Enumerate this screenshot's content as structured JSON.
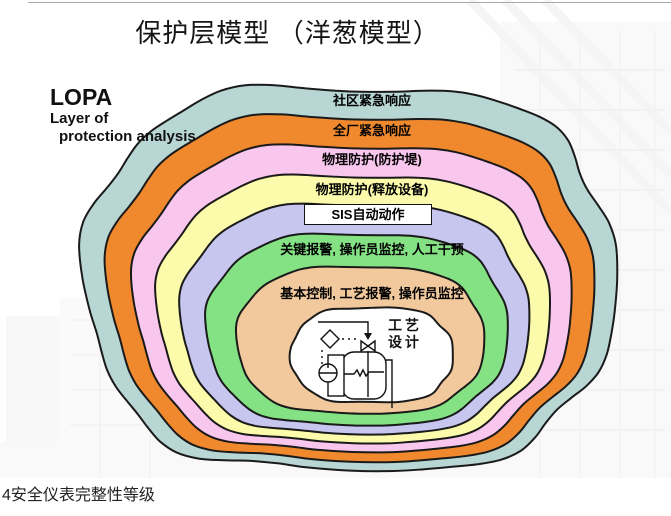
{
  "title": "保护层模型 （洋葱模型）",
  "lopa": {
    "acronym": "LOPA",
    "subtitle_line1": "Layer of",
    "subtitle_line2": "protection analysis"
  },
  "layers": [
    {
      "label": "社区紧急响应",
      "color": "#b7d6d4"
    },
    {
      "label": "全厂紧急响应",
      "color": "#f0892e"
    },
    {
      "label": "物理防护(防护堤)",
      "color": "#f9c6ee"
    },
    {
      "label": "物理防护(释放设备)",
      "color": "#fbfbab"
    },
    {
      "label": "SIS自动动作",
      "color": "#c6c6ef"
    },
    {
      "label": "关键报警, 操作员监控, 人工干预",
      "color": "#84e184"
    },
    {
      "label": "基本控制, 工艺报警, 操作员监控",
      "color": "#f2c99d"
    },
    {
      "label": "工艺设计",
      "color": "#ffffff"
    }
  ],
  "center_label": {
    "line1": "工艺",
    "line2": "设计"
  },
  "outline_color": "#1a1a1a",
  "footer": "4安全仪表完整性等级"
}
